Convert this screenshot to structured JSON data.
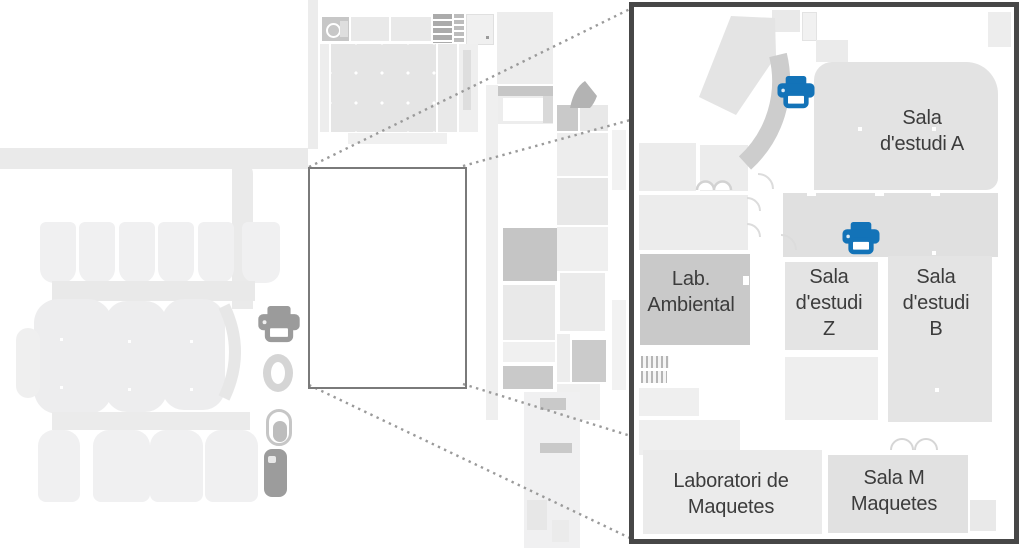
{
  "figure": {
    "type": "campus-floor-plan-with-magnified-callout",
    "background": "#ffffff"
  },
  "colors": {
    "printer_blue": "#1373b8",
    "room_light": "#ececec",
    "room_mid": "#e0e0e0",
    "room_dark": "#c9c9c9",
    "frame_border": "#474747",
    "highlight_border": "#7a7a7a",
    "dotted_line": "#9a9a9a",
    "label_text": "#3c3c3c"
  },
  "detail": {
    "rooms": [
      {
        "name": "sala-destudi-a",
        "lines": [
          "Sala",
          "d'estudi A"
        ]
      },
      {
        "name": "lab-ambiental",
        "lines": [
          "Lab.",
          "Ambiental"
        ]
      },
      {
        "name": "sala-destudi-z",
        "lines": [
          "Sala",
          "d'estudi",
          "Z"
        ]
      },
      {
        "name": "sala-destudi-b",
        "lines": [
          "Sala",
          "d'estudi",
          "B"
        ]
      },
      {
        "name": "laboratori-de-maquetes",
        "lines": [
          "Laboratori de",
          "Maquetes"
        ]
      },
      {
        "name": "sala-m-maquetes",
        "lines": [
          "Sala M",
          "Maquetes"
        ]
      }
    ],
    "icons": [
      {
        "name": "printer-icon",
        "color": "#1373b8",
        "count": 2
      },
      {
        "name": "stairs-icon"
      },
      {
        "name": "door-swing-arcs"
      }
    ]
  },
  "overview": {
    "icons": [
      {
        "name": "printer-icon-gray",
        "color": "#9b9b9b"
      },
      {
        "name": "elevator-ring-icon"
      },
      {
        "name": "restroom-capsule-icon"
      },
      {
        "name": "utility-key-icon"
      }
    ]
  }
}
